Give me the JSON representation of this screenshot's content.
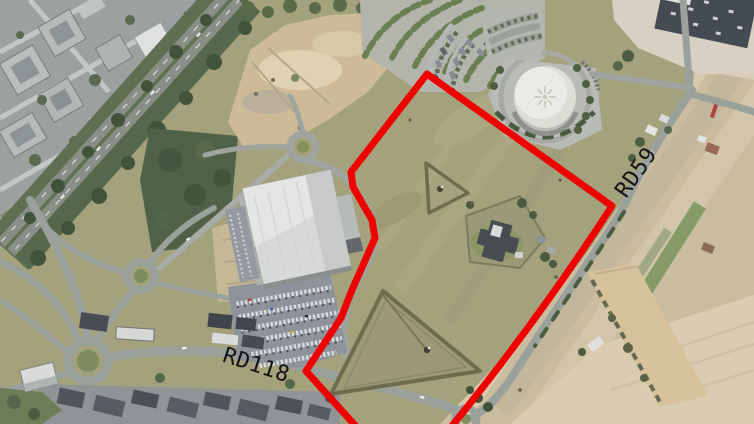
{
  "map": {
    "type": "aerial-satellite-photo",
    "road_labels": {
      "rd118": "RD118",
      "rd59": "RD59",
      "color": "#141414"
    },
    "parcel_boundary": {
      "color": "#ee0000",
      "stroke_width_px": 7
    }
  }
}
